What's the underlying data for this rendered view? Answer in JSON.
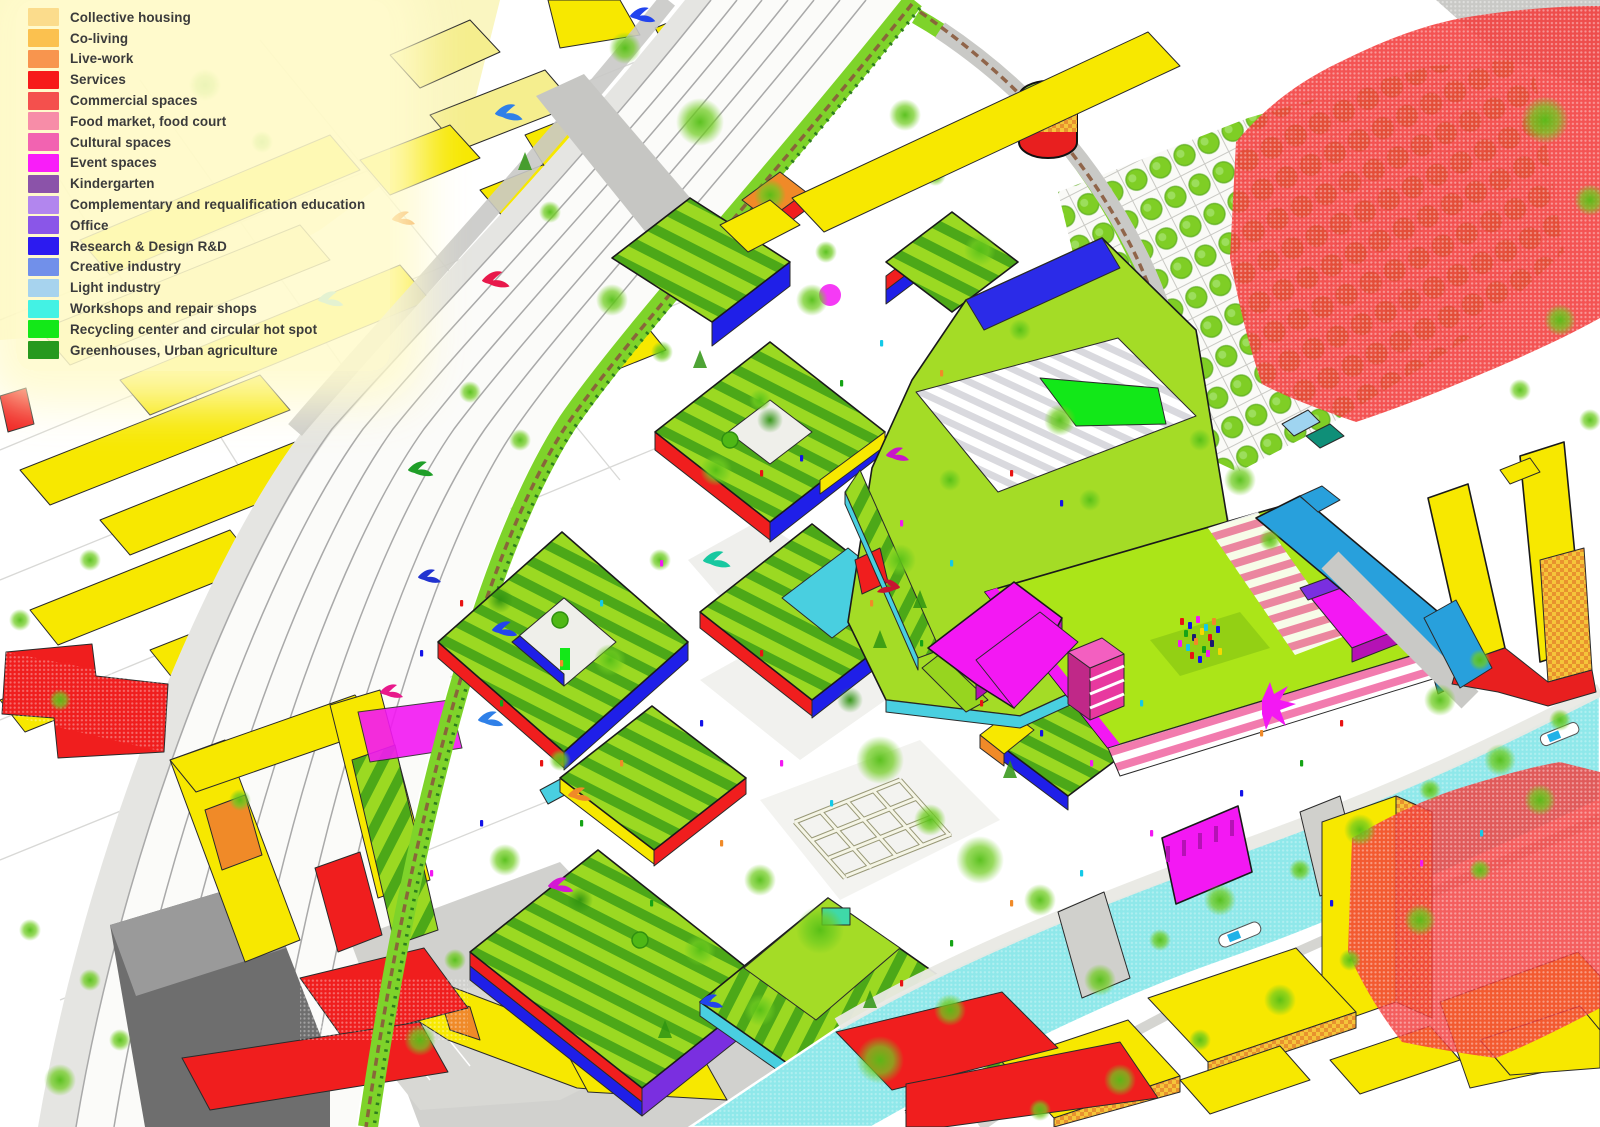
{
  "legend": {
    "items": [
      {
        "key": "collective-housing",
        "label": "Collective housing",
        "color": "#FBDC8C"
      },
      {
        "key": "co-living",
        "label": "Co-living",
        "color": "#FBC14F"
      },
      {
        "key": "live-work",
        "label": "Live-work",
        "color": "#F8954E"
      },
      {
        "key": "services",
        "label": "Services",
        "color": "#F71A1A"
      },
      {
        "key": "commercial-spaces",
        "label": "Commercial spaces",
        "color": "#F4504D"
      },
      {
        "key": "food-market-food-court",
        "label": "Food market, food court",
        "color": "#F78DA8"
      },
      {
        "key": "cultural-spaces",
        "label": "Cultural spaces",
        "color": "#F263B1"
      },
      {
        "key": "event-spaces",
        "label": "Event spaces",
        "color": "#F91DF9"
      },
      {
        "key": "kindergarten",
        "label": "Kindergarten",
        "color": "#8B53A9"
      },
      {
        "key": "complementary-requalification-education",
        "label": "Complementary and requalification education",
        "color": "#B286EE"
      },
      {
        "key": "office",
        "label": "Office",
        "color": "#8A56E8"
      },
      {
        "key": "research-design-rd",
        "label": "Research & Design R&D",
        "color": "#2C1BF0"
      },
      {
        "key": "creative-industry",
        "label": "Creative industry",
        "color": "#7190EA"
      },
      {
        "key": "light-industry",
        "label": "Light industry",
        "color": "#A7D3EE"
      },
      {
        "key": "workshops-repair-shops",
        "label": "Workshops and repair shops",
        "color": "#43F2E4"
      },
      {
        "key": "recycling-center-circular-hot-spot",
        "label": "Recycling center and circular hot spot",
        "color": "#13E818"
      },
      {
        "key": "greenhouses-urban-agriculture",
        "label": "Greenhouses, Urban agriculture",
        "color": "#27991E"
      }
    ]
  },
  "palette": {
    "canal_water": "#8FE8EA",
    "lawn_green": "#ABE518",
    "roof_green": "#A4DC26",
    "verge_green": "#7ED32A",
    "existing_yellow": "#F7E800",
    "red_zone": "#F23B3B",
    "service_red": "#F01E1E",
    "event_magenta": "#F318F3",
    "light_industry_blue": "#28A0DC",
    "workshop_cyan": "#49CFE0",
    "rail_grey": "#A9A9A9",
    "gasholder_top": "#9FE020",
    "gasholder_band_red": "#E81F1F",
    "gasholder_band_checker": "#F5C53A"
  }
}
